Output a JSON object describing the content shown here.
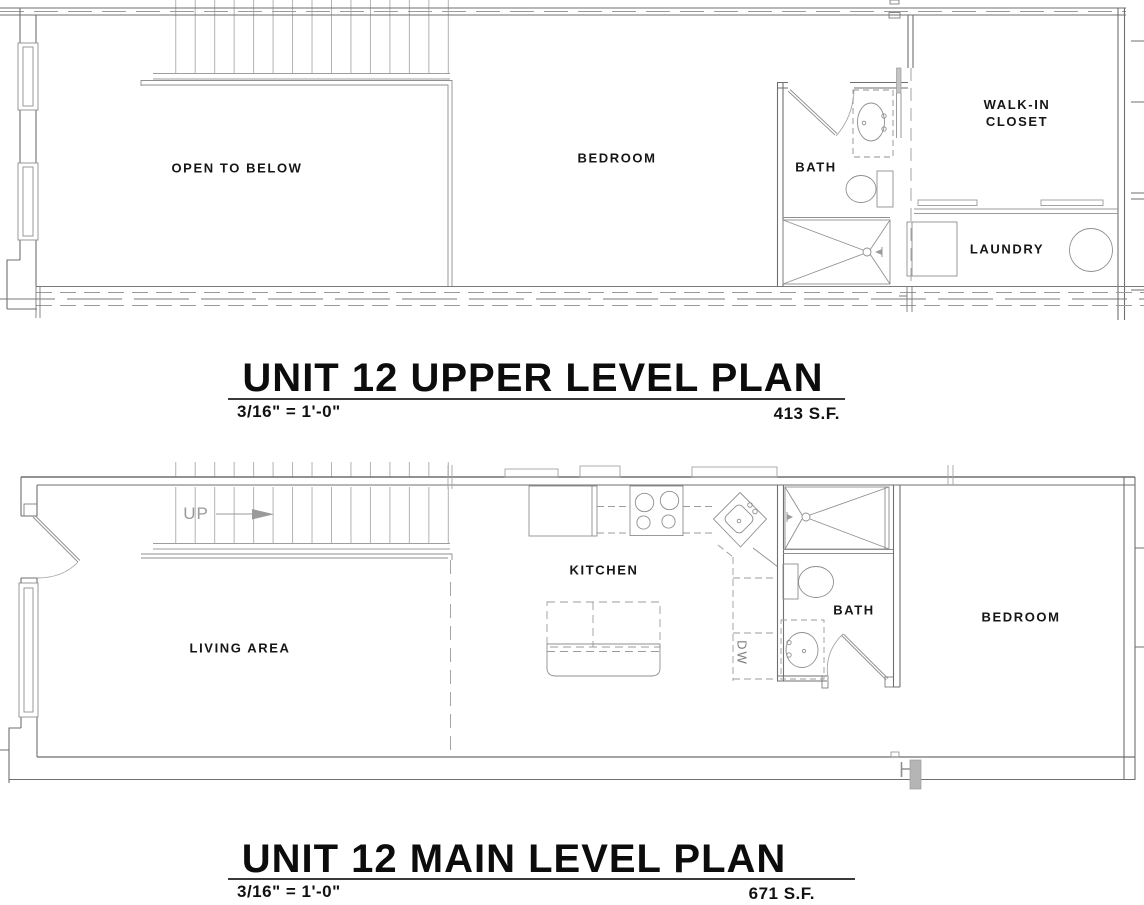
{
  "upper_plan": {
    "title": "UNIT 12 UPPER LEVEL PLAN",
    "scale": "3/16\" = 1'-0\"",
    "area": "413 S.F.",
    "rooms": {
      "open_to_below": "OPEN TO BELOW",
      "bedroom": "BEDROOM",
      "bath": "BATH",
      "walk_in_closet_line1": "WALK-IN",
      "walk_in_closet_line2": "CLOSET",
      "laundry": "LAUNDRY"
    }
  },
  "main_plan": {
    "title": "UNIT 12 MAIN LEVEL PLAN",
    "scale": "3/16\" = 1'-0\"",
    "area": "671 S.F.",
    "rooms": {
      "living_area": "LIVING AREA",
      "kitchen": "KITCHEN",
      "bath": "BATH",
      "bedroom": "BEDROOM"
    },
    "stair_direction": "UP",
    "dishwasher": "DW"
  },
  "colors": {
    "wall_line": "#6f6f6f",
    "fixture_line": "#8f8f8f",
    "stair_line": "#ababab",
    "label_text": "#161616",
    "title_text": "#0c0c0c"
  }
}
